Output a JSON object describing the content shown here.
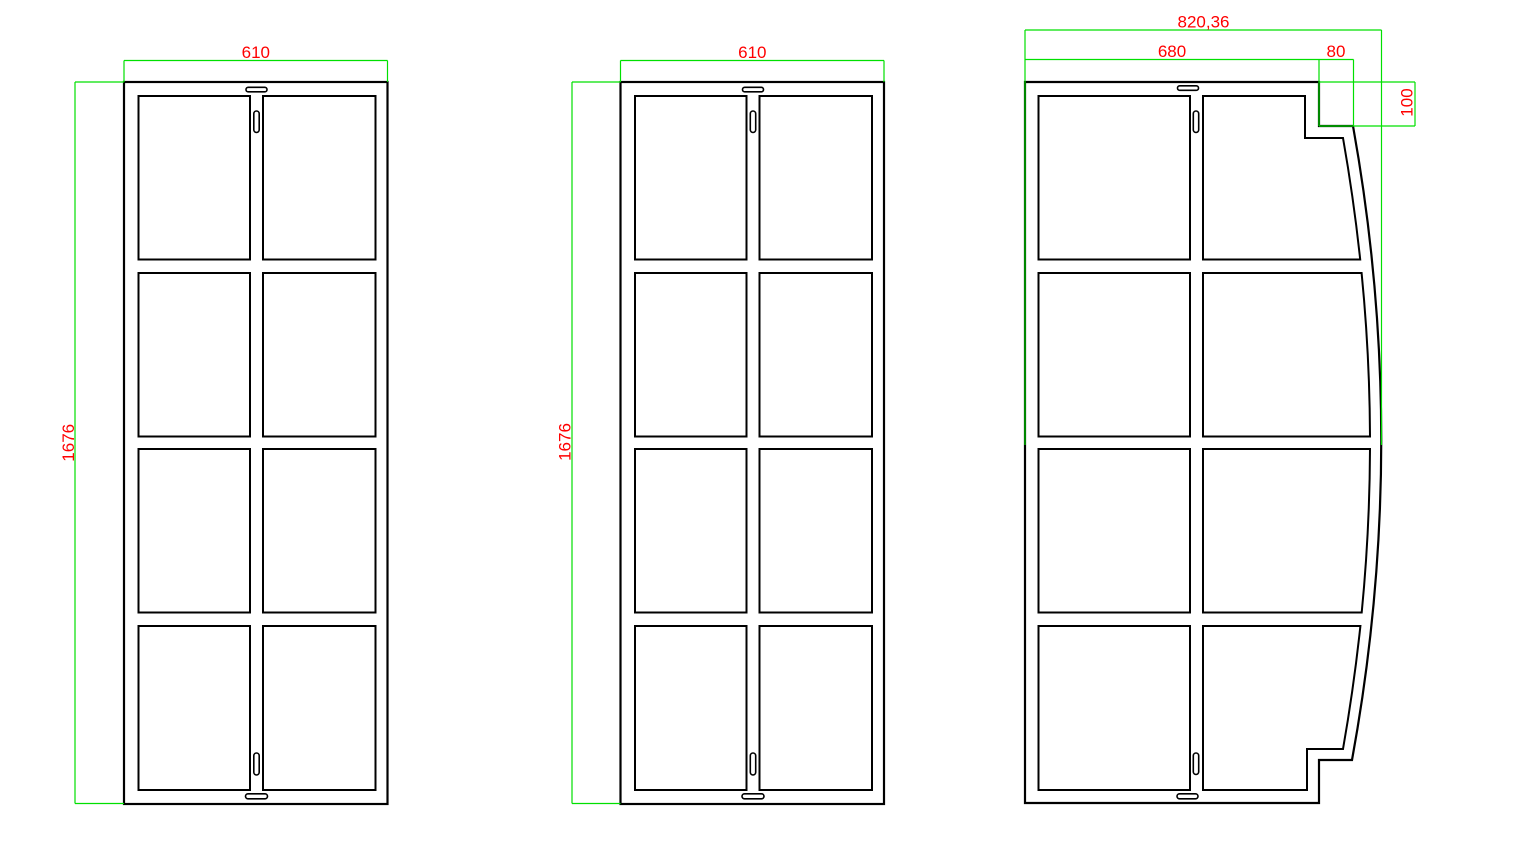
{
  "app": {
    "type": "cad-elevation-drawing",
    "background": "#FFFFFF"
  },
  "colors": {
    "outline": "#000000",
    "dimension_line": "#00E000",
    "dimension_text": "#FF0000"
  },
  "panels": [
    {
      "name": "panel-left",
      "grid": "2 columns x 4 rows",
      "dimensions": {
        "width": "610",
        "height": "1676"
      }
    },
    {
      "name": "panel-middle",
      "grid": "2 columns x 4 rows",
      "dimensions": {
        "width": "610",
        "height": "1676"
      }
    },
    {
      "name": "panel-right",
      "grid": "2 columns x 4 rows, curved right edge",
      "dimensions": {
        "overall_width": "820,36",
        "main_width": "680",
        "corner_step_width": "80",
        "corner_step_height": "100"
      }
    }
  ]
}
